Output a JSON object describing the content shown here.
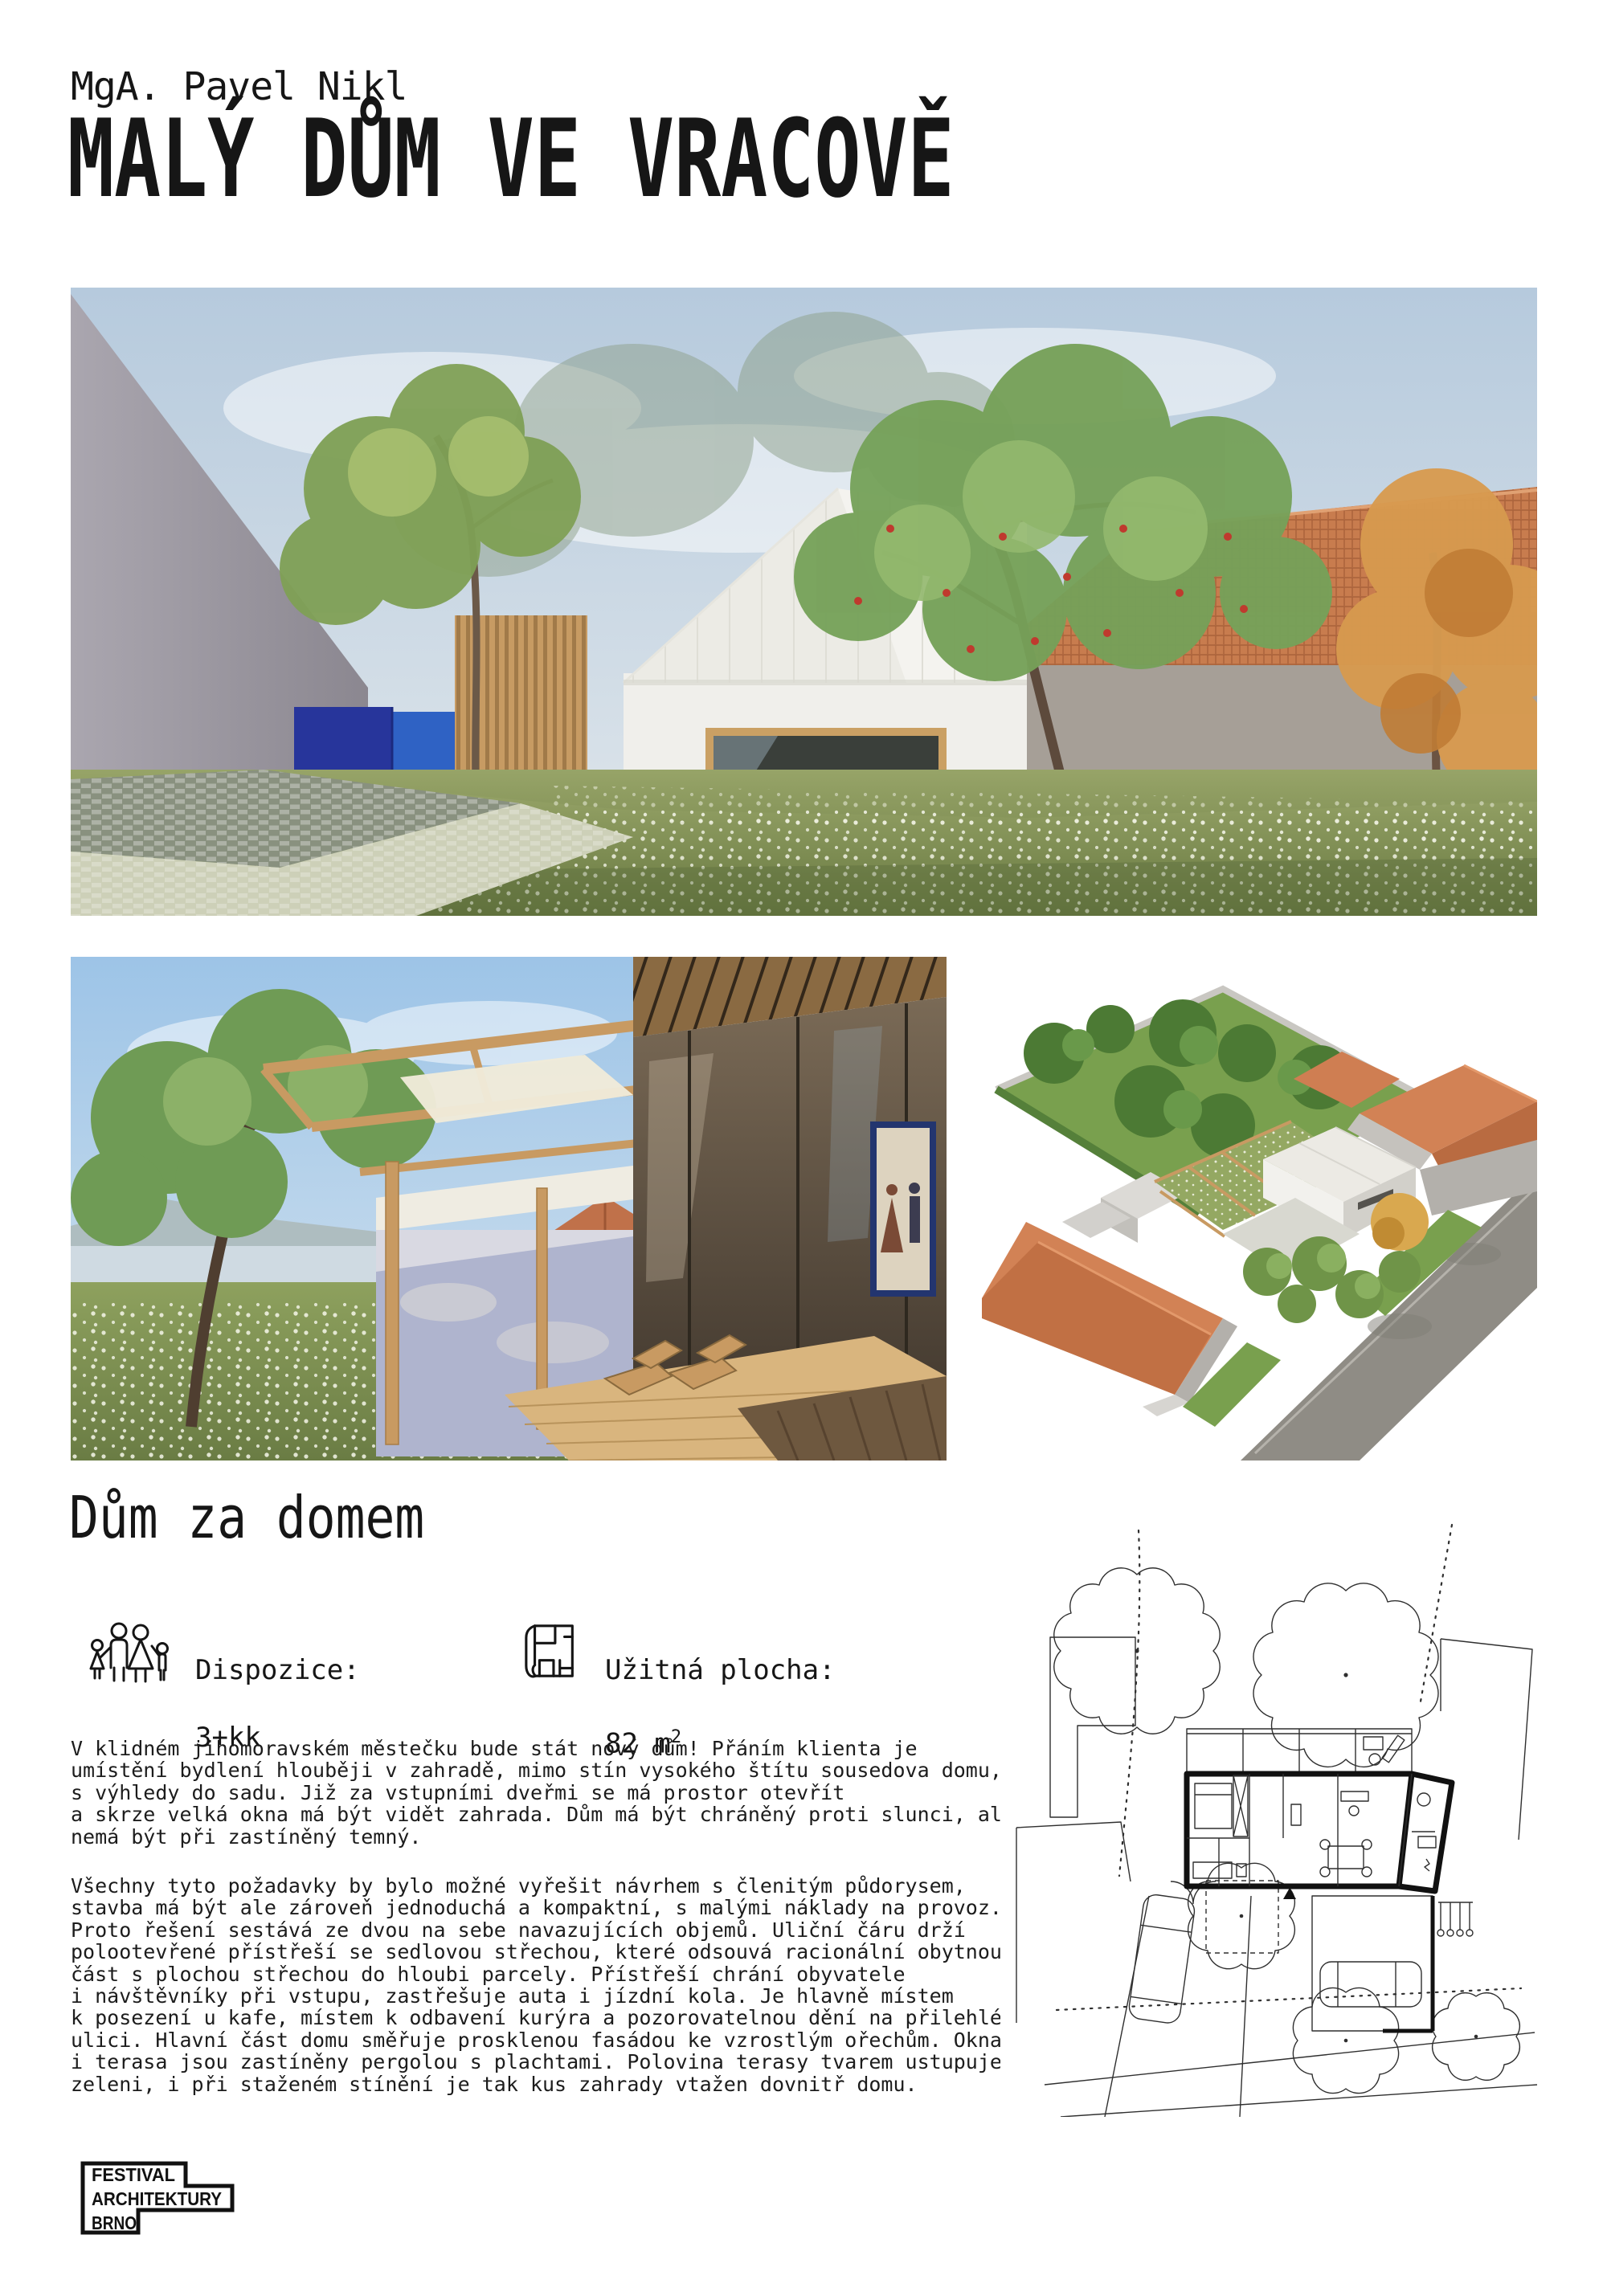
{
  "header": {
    "author": "MgA. Pavel Nikl",
    "title": "MALÝ DŮM VE VRACOVĚ"
  },
  "section": {
    "heading": "Dům za domem"
  },
  "info": {
    "dispozice_label": "Dispozice:",
    "dispozice_value": "3+kk",
    "plocha_label": "Užitná plocha:",
    "plocha_value_base": "82 m",
    "plocha_value_sup": "2",
    "icons": {
      "family": "family-icon",
      "floorplan": "floorplan-icon"
    }
  },
  "content": {
    "paragraph1": "V klidném jihomoravském městečku bude stát nový dům! Přáním klienta je\numístění bydlení hlouběji v zahradě, mimo stín vysokého štítu sousedova domu,\ns výhledy do sadu. Již za vstupními dveřmi se má prostor otevřít\na skrze velká okna má být vidět zahrada. Dům má být chráněný proti slunci, ale\nnemá být při zastíněný temný.",
    "paragraph2": "Všechny tyto požadavky by bylo možné vyřešit návrhem s členitým půdorysem,\nstavba má být ale zároveň jednoduchá a kompaktní, s malými náklady na provoz.\nProto řešení sestává ze dvou na sebe navazujících objemů. Uliční čáru drží\npolootevřené přístřeší se sedlovou střechou, které odsouvá racionální obytnou\nčást s plochou střechou do hloubi parcely. Přístřeší chrání obyvatele\ni návštěvníky při vstupu, zastřešuje auta i jízdní kola. Je hlavně místem\nk posezení u kafe, místem k odbavení kurýra a pozorovatelnou dění na přilehlé\nulici. Hlavní část domu směřuje prosklenou fasádou ke vzrostlým ořechům. Okna\ni terasa jsou zastíněny pergolou s plachtami. Polovina terasy tvarem ustupuje\nzeleni, i při staženém stínění je tak kus zahrady vtažen dovnitř domu."
  },
  "footer": {
    "logo_lines": [
      "FESTIVAL",
      "ARCHITEKTURY",
      "BRNO"
    ]
  },
  "figures": {
    "hero": "garden-view-render",
    "courtyard": "pergola-terrace-render",
    "axon": "aerial-axonometry-render",
    "siteplan": "site-plan-drawing"
  },
  "colors": {
    "accent_blue": "#2a3aa0",
    "roof_orange": "#c87c4e",
    "meadow_green": "#87985c",
    "wood": "#c79b63",
    "ink": "#161616"
  }
}
